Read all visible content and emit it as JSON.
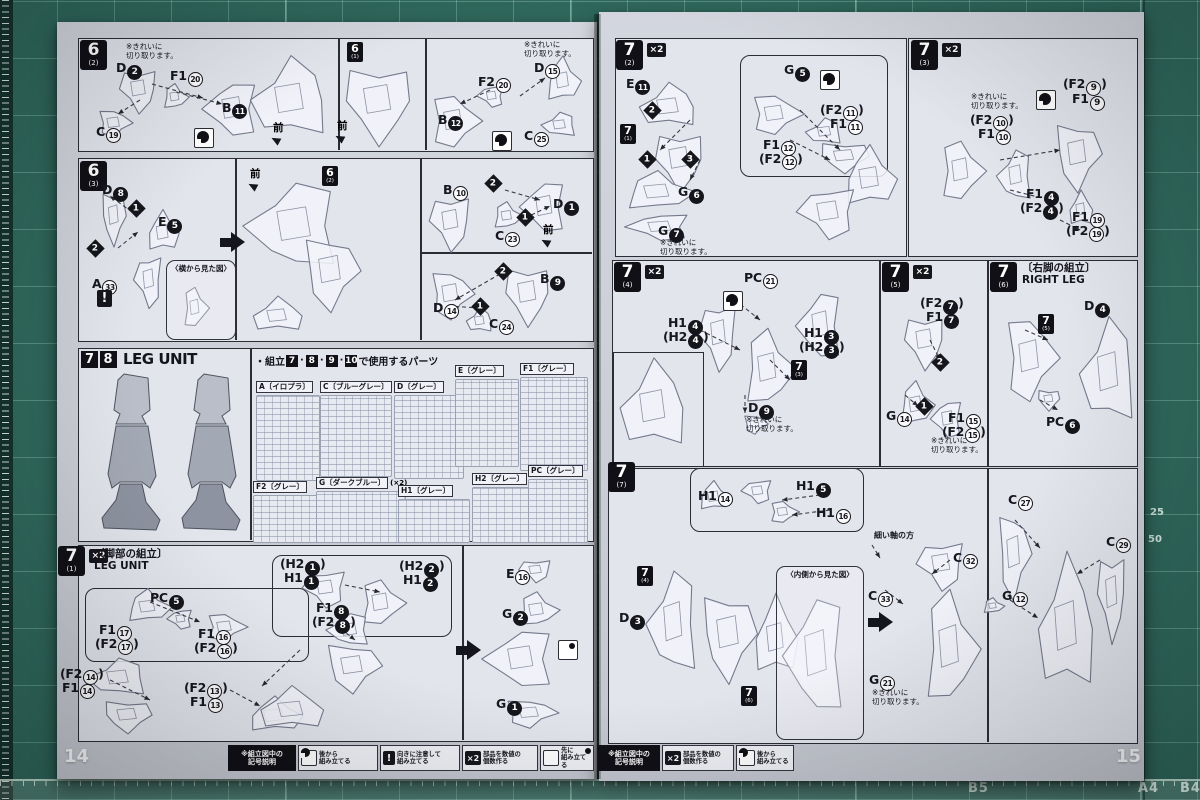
{
  "misc": {
    "x2_label": "×2",
    "warning_glyph": "!"
  },
  "mat": {
    "bottom_labels": [
      {
        "t": "B5",
        "x": 968
      },
      {
        "t": "A4",
        "x": 1138
      },
      {
        "t": "B4",
        "x": 1180
      }
    ],
    "side_labels": [
      {
        "t": "25",
        "x": 1150,
        "y": 507
      },
      {
        "t": "50",
        "x": 1148,
        "y": 534
      }
    ]
  },
  "left_page": {
    "page_number": "14",
    "legend": {
      "x": 228,
      "y": 745,
      "title": "※組立図中の\n記号説明",
      "title_w": 68,
      "items": [
        {
          "icon": "after",
          "t": "後から\n組み立てる",
          "x": 298,
          "w": 80
        },
        {
          "icon": "warning",
          "t": "向きに注意して\n組み立てる",
          "x": 380,
          "w": 80
        },
        {
          "icon": "x2",
          "t": "部品を数値の\n個数作る",
          "x": 462,
          "w": 76
        },
        {
          "icon": "first",
          "t": "先に\n組み立てる",
          "x": 540,
          "w": 54
        }
      ]
    },
    "items": [
      {
        "k": "tag",
        "x": 80,
        "y": 40,
        "num": "6",
        "sub": "(2)"
      },
      {
        "k": "note",
        "x": 126,
        "y": 42,
        "t": "※きれいに\n切り取ります。"
      },
      {
        "k": "part",
        "x": 116,
        "y": 60,
        "t": "D",
        "n": 2,
        "f": 1
      },
      {
        "k": "part",
        "x": 170,
        "y": 68,
        "t": "F1",
        "n": 20
      },
      {
        "k": "part",
        "x": 222,
        "y": 100,
        "t": "B",
        "n": 11,
        "f": 1
      },
      {
        "k": "part",
        "x": 96,
        "y": 124,
        "t": "C",
        "n": 19
      },
      {
        "k": "sym",
        "x": 194,
        "y": 128,
        "icon": "after"
      },
      {
        "k": "dir",
        "x": 273,
        "y": 120,
        "t": "前"
      },
      {
        "k": "ref",
        "x": 347,
        "y": 42,
        "num": "6",
        "sub": "(1)"
      },
      {
        "k": "dir",
        "x": 337,
        "y": 118,
        "t": "前"
      },
      {
        "k": "note",
        "x": 524,
        "y": 40,
        "t": "※きれいに\n切り取ります。"
      },
      {
        "k": "part",
        "x": 534,
        "y": 60,
        "t": "D",
        "n": 15
      },
      {
        "k": "part",
        "x": 478,
        "y": 74,
        "t": "F2",
        "n": 20
      },
      {
        "k": "part",
        "x": 438,
        "y": 112,
        "t": "B",
        "n": 12,
        "f": 1
      },
      {
        "k": "part",
        "x": 524,
        "y": 128,
        "t": "C",
        "n": 25
      },
      {
        "k": "sym",
        "x": 492,
        "y": 131,
        "icon": "after"
      },
      {
        "k": "tag",
        "x": 80,
        "y": 161,
        "num": "6",
        "sub": "(3)"
      },
      {
        "k": "part",
        "x": 102,
        "y": 182,
        "t": "D",
        "n": 8,
        "f": 1
      },
      {
        "k": "dia",
        "x": 130,
        "y": 202,
        "n": 1
      },
      {
        "k": "part",
        "x": 158,
        "y": 214,
        "t": "E",
        "n": 5,
        "f": 1
      },
      {
        "k": "dia",
        "x": 89,
        "y": 242,
        "n": 2
      },
      {
        "k": "part",
        "x": 92,
        "y": 276,
        "t": "A",
        "n": 33
      },
      {
        "k": "sym",
        "x": 97,
        "y": 290,
        "icon": "warning"
      },
      {
        "k": "callout",
        "x": 166,
        "y": 260,
        "w": 68,
        "h": 78,
        "t": "〈横から見た図〉"
      },
      {
        "k": "dir",
        "x": 250,
        "y": 166,
        "t": "前"
      },
      {
        "k": "bigarrow",
        "x": 220,
        "y": 232
      },
      {
        "k": "ref",
        "x": 322,
        "y": 166,
        "num": "6",
        "sub": "(2)"
      },
      {
        "k": "part",
        "x": 443,
        "y": 182,
        "t": "B",
        "n": 10
      },
      {
        "k": "dia",
        "x": 487,
        "y": 177,
        "n": 2
      },
      {
        "k": "part",
        "x": 553,
        "y": 196,
        "t": "D",
        "n": 1,
        "f": 1
      },
      {
        "k": "dia",
        "x": 519,
        "y": 211,
        "n": 1
      },
      {
        "k": "part",
        "x": 495,
        "y": 228,
        "t": "C",
        "n": 23
      },
      {
        "k": "dir",
        "x": 543,
        "y": 222,
        "t": "前"
      },
      {
        "k": "dia",
        "x": 497,
        "y": 265,
        "n": 2
      },
      {
        "k": "part",
        "x": 540,
        "y": 271,
        "t": "B",
        "n": 9,
        "f": 1
      },
      {
        "k": "part",
        "x": 433,
        "y": 300,
        "t": "D",
        "n": 14
      },
      {
        "k": "dia",
        "x": 474,
        "y": 300,
        "n": 1
      },
      {
        "k": "part",
        "x": 489,
        "y": 316,
        "t": "C",
        "n": 24
      },
      {
        "k": "boxhead",
        "x": 81,
        "y": 350,
        "nums": [
          "7",
          "8"
        ],
        "t": "LEG UNIT"
      },
      {
        "k": "plisthead",
        "x": 255,
        "y": 353,
        "pre": "・組立",
        "nums": [
          "7",
          "8",
          "9",
          "10"
        ],
        "post": "で使用するパーツ"
      },
      {
        "k": "runner",
        "x": 256,
        "y": 374,
        "t": "A〔イロプラ〕",
        "tw": 62,
        "th": 84
      },
      {
        "k": "runner",
        "x": 320,
        "y": 374,
        "t": "C〔ブルーグレー〕",
        "tw": 70,
        "th": 80
      },
      {
        "k": "runner",
        "x": 394,
        "y": 374,
        "t": "D〔グレー〕",
        "tw": 68,
        "th": 82
      },
      {
        "k": "runner",
        "x": 455,
        "y": 358,
        "t": "E〔グレー〕",
        "tw": 62,
        "th": 86
      },
      {
        "k": "runner",
        "x": 520,
        "y": 356,
        "t": "F1〔グレー〕",
        "tw": 66,
        "th": 92
      },
      {
        "k": "runner",
        "x": 253,
        "y": 474,
        "t": "F2〔グレー〕",
        "tw": 64,
        "th": 46
      },
      {
        "k": "runner",
        "x": 316,
        "y": 470,
        "t": "G〔ダークブルー〕",
        "extra": "(×2)",
        "tw": 88,
        "th": 50
      },
      {
        "k": "runner",
        "x": 398,
        "y": 478,
        "t": "H1〔グレー〕",
        "tw": 70,
        "th": 42
      },
      {
        "k": "runner",
        "x": 472,
        "y": 466,
        "t": "H2〔グレー〕",
        "tw": 56,
        "th": 54
      },
      {
        "k": "runner",
        "x": 528,
        "y": 458,
        "t": "PC〔グレー〕",
        "tw": 58,
        "th": 62
      },
      {
        "k": "tag",
        "x": 58,
        "y": 546,
        "num": "7",
        "sub": "(1)",
        "x2": 1
      },
      {
        "k": "head2",
        "x": 94,
        "y": 548,
        "t1": "〔脚部の組立〕",
        "t2": "LEG UNIT"
      },
      {
        "k": "part",
        "x": 150,
        "y": 590,
        "t": "PC",
        "n": 5,
        "f": 1
      },
      {
        "k": "part",
        "x": 99,
        "y": 622,
        "t": "F1",
        "n": 17
      },
      {
        "k": "part",
        "x": 95,
        "y": 636,
        "t": "F2",
        "n": 17,
        "p": 1
      },
      {
        "k": "part",
        "x": 198,
        "y": 626,
        "t": "F1",
        "n": 16
      },
      {
        "k": "part",
        "x": 194,
        "y": 640,
        "t": "F2",
        "n": 16,
        "p": 1
      },
      {
        "k": "part",
        "x": 60,
        "y": 666,
        "t": "F2",
        "n": 14,
        "p": 1
      },
      {
        "k": "part",
        "x": 62,
        "y": 680,
        "t": "F1",
        "n": 14
      },
      {
        "k": "part",
        "x": 184,
        "y": 680,
        "t": "F2",
        "n": 13,
        "p": 1
      },
      {
        "k": "part",
        "x": 190,
        "y": 694,
        "t": "F1",
        "n": 13
      },
      {
        "k": "part",
        "x": 280,
        "y": 556,
        "t": "H2",
        "n": 1,
        "f": 1,
        "p": 1
      },
      {
        "k": "part",
        "x": 284,
        "y": 570,
        "t": "H1",
        "n": 1,
        "f": 1
      },
      {
        "k": "part",
        "x": 399,
        "y": 558,
        "t": "H2",
        "n": 2,
        "f": 1,
        "p": 1
      },
      {
        "k": "part",
        "x": 403,
        "y": 572,
        "t": "H1",
        "n": 2,
        "f": 1
      },
      {
        "k": "part",
        "x": 316,
        "y": 600,
        "t": "F1",
        "n": 8,
        "f": 1
      },
      {
        "k": "part",
        "x": 312,
        "y": 614,
        "t": "F2",
        "n": 8,
        "f": 1,
        "p": 1
      },
      {
        "k": "bigarrow",
        "x": 456,
        "y": 640
      },
      {
        "k": "part",
        "x": 506,
        "y": 566,
        "t": "E",
        "n": 16
      },
      {
        "k": "part",
        "x": 502,
        "y": 606,
        "t": "G",
        "n": 2,
        "f": 1
      },
      {
        "k": "sym",
        "x": 558,
        "y": 640,
        "icon": "first"
      },
      {
        "k": "part",
        "x": 496,
        "y": 696,
        "t": "G",
        "n": 1,
        "f": 1
      }
    ]
  },
  "right_page": {
    "page_number": "15",
    "legend": {
      "x": 598,
      "y": 745,
      "title": "※組立図中の\n記号説明",
      "title_w": 62,
      "items": [
        {
          "icon": "x2",
          "t": "部品を数値の\n個数作る",
          "x": 662,
          "w": 72
        },
        {
          "icon": "after",
          "t": "後から\n組み立てる",
          "x": 736,
          "w": 58
        }
      ]
    },
    "items": [
      {
        "k": "tag",
        "x": 616,
        "y": 40,
        "num": "7",
        "sub": "(2)",
        "x2": 1
      },
      {
        "k": "part",
        "x": 626,
        "y": 76,
        "t": "E",
        "n": 11,
        "f": 1
      },
      {
        "k": "dia",
        "x": 646,
        "y": 104,
        "n": 2
      },
      {
        "k": "ref",
        "x": 620,
        "y": 124,
        "num": "7",
        "sub": "(1)"
      },
      {
        "k": "dia",
        "x": 641,
        "y": 153,
        "n": 1
      },
      {
        "k": "dia",
        "x": 684,
        "y": 153,
        "n": 3
      },
      {
        "k": "part",
        "x": 678,
        "y": 184,
        "t": "G",
        "n": 6,
        "f": 1
      },
      {
        "k": "part",
        "x": 658,
        "y": 223,
        "t": "G",
        "n": 7,
        "f": 1
      },
      {
        "k": "note",
        "x": 660,
        "y": 238,
        "t": "※きれいに\n切り取ります。"
      },
      {
        "k": "part",
        "x": 784,
        "y": 62,
        "t": "G",
        "n": 5,
        "f": 1
      },
      {
        "k": "sym",
        "x": 820,
        "y": 70,
        "icon": "after"
      },
      {
        "k": "part",
        "x": 820,
        "y": 102,
        "t": "F2",
        "n": 11,
        "p": 1
      },
      {
        "k": "part",
        "x": 830,
        "y": 116,
        "t": "F1",
        "n": 11
      },
      {
        "k": "part",
        "x": 763,
        "y": 137,
        "t": "F1",
        "n": 12
      },
      {
        "k": "part",
        "x": 759,
        "y": 151,
        "t": "F2",
        "n": 12,
        "p": 1
      },
      {
        "k": "tag",
        "x": 911,
        "y": 40,
        "num": "7",
        "sub": "(3)",
        "x2": 1
      },
      {
        "k": "note",
        "x": 971,
        "y": 92,
        "t": "※きれいに\n切り取ります。"
      },
      {
        "k": "sym",
        "x": 1036,
        "y": 90,
        "icon": "after"
      },
      {
        "k": "part",
        "x": 1063,
        "y": 76,
        "t": "F2",
        "n": 9,
        "p": 1
      },
      {
        "k": "part",
        "x": 1072,
        "y": 91,
        "t": "F1",
        "n": 9
      },
      {
        "k": "part",
        "x": 970,
        "y": 112,
        "t": "F2",
        "n": 10,
        "p": 1
      },
      {
        "k": "part",
        "x": 978,
        "y": 126,
        "t": "F1",
        "n": 10
      },
      {
        "k": "part",
        "x": 1026,
        "y": 186,
        "t": "F1",
        "n": 4,
        "f": 1
      },
      {
        "k": "part",
        "x": 1020,
        "y": 200,
        "t": "F2",
        "n": 4,
        "f": 1,
        "p": 1
      },
      {
        "k": "part",
        "x": 1072,
        "y": 209,
        "t": "F1",
        "n": 19
      },
      {
        "k": "part",
        "x": 1066,
        "y": 223,
        "t": "F2",
        "n": 19,
        "p": 1
      },
      {
        "k": "tag",
        "x": 614,
        "y": 262,
        "num": "7",
        "sub": "(4)",
        "x2": 1
      },
      {
        "k": "part",
        "x": 744,
        "y": 270,
        "t": "PC",
        "n": 21
      },
      {
        "k": "sym",
        "x": 723,
        "y": 291,
        "icon": "after"
      },
      {
        "k": "part",
        "x": 668,
        "y": 315,
        "t": "H1",
        "n": 4,
        "f": 1
      },
      {
        "k": "part",
        "x": 663,
        "y": 329,
        "t": "H2",
        "n": 4,
        "f": 1,
        "p": 1
      },
      {
        "k": "part",
        "x": 804,
        "y": 325,
        "t": "H1",
        "n": 3,
        "f": 1
      },
      {
        "k": "part",
        "x": 799,
        "y": 339,
        "t": "H2",
        "n": 3,
        "f": 1,
        "p": 1
      },
      {
        "k": "ref",
        "x": 791,
        "y": 360,
        "num": "7",
        "sub": "(3)"
      },
      {
        "k": "part",
        "x": 748,
        "y": 400,
        "t": "D",
        "n": 9,
        "f": 1
      },
      {
        "k": "note",
        "x": 746,
        "y": 415,
        "t": "※きれいに\n切り取ります。"
      },
      {
        "k": "tag",
        "x": 882,
        "y": 262,
        "num": "7",
        "sub": "(5)",
        "x2": 1
      },
      {
        "k": "part",
        "x": 920,
        "y": 295,
        "t": "F2",
        "n": 7,
        "f": 1,
        "p": 1
      },
      {
        "k": "part",
        "x": 926,
        "y": 309,
        "t": "F1",
        "n": 7,
        "f": 1
      },
      {
        "k": "dia",
        "x": 934,
        "y": 356,
        "n": 2
      },
      {
        "k": "dia",
        "x": 918,
        "y": 400,
        "n": 1
      },
      {
        "k": "part",
        "x": 886,
        "y": 408,
        "t": "G",
        "n": 14
      },
      {
        "k": "part",
        "x": 948,
        "y": 410,
        "t": "F1",
        "n": 15
      },
      {
        "k": "part",
        "x": 942,
        "y": 424,
        "t": "F2",
        "n": 15,
        "p": 1
      },
      {
        "k": "note",
        "x": 931,
        "y": 436,
        "t": "※きれいに\n切り取ります。"
      },
      {
        "k": "tag",
        "x": 990,
        "y": 262,
        "num": "7",
        "sub": "(6)"
      },
      {
        "k": "head2",
        "x": 1022,
        "y": 262,
        "t1": "〔右脚の組立〕",
        "t2": "RIGHT LEG"
      },
      {
        "k": "part",
        "x": 1084,
        "y": 298,
        "t": "D",
        "n": 4,
        "f": 1
      },
      {
        "k": "ref",
        "x": 1038,
        "y": 314,
        "num": "7",
        "sub": "(5)"
      },
      {
        "k": "part",
        "x": 1046,
        "y": 414,
        "t": "PC",
        "n": 6,
        "f": 1
      },
      {
        "k": "tag",
        "x": 608,
        "y": 462,
        "num": "7",
        "sub": "(7)"
      },
      {
        "k": "part",
        "x": 698,
        "y": 488,
        "t": "H1",
        "n": 14
      },
      {
        "k": "part",
        "x": 796,
        "y": 478,
        "t": "H1",
        "n": 5,
        "f": 1
      },
      {
        "k": "part",
        "x": 816,
        "y": 505,
        "t": "H1",
        "n": 16
      },
      {
        "k": "annot",
        "x": 874,
        "y": 530,
        "t": "細い軸の方"
      },
      {
        "k": "ref",
        "x": 637,
        "y": 566,
        "num": "7",
        "sub": "(4)"
      },
      {
        "k": "part",
        "x": 619,
        "y": 610,
        "t": "D",
        "n": 3,
        "f": 1
      },
      {
        "k": "callout",
        "x": 776,
        "y": 566,
        "w": 86,
        "h": 172,
        "t": "〈内側から見た図〉"
      },
      {
        "k": "part",
        "x": 953,
        "y": 550,
        "t": "C",
        "n": 32
      },
      {
        "k": "part",
        "x": 868,
        "y": 588,
        "t": "C",
        "n": 33
      },
      {
        "k": "ref",
        "x": 741,
        "y": 686,
        "num": "7",
        "sub": "(6)"
      },
      {
        "k": "part",
        "x": 869,
        "y": 672,
        "t": "G",
        "n": 21
      },
      {
        "k": "note",
        "x": 872,
        "y": 688,
        "t": "※きれいに\n切り取ります。"
      },
      {
        "k": "bigarrow",
        "x": 868,
        "y": 612
      },
      {
        "k": "part",
        "x": 1008,
        "y": 492,
        "t": "C",
        "n": 27
      },
      {
        "k": "part",
        "x": 1002,
        "y": 588,
        "t": "G",
        "n": 12
      },
      {
        "k": "part",
        "x": 1106,
        "y": 534,
        "t": "C",
        "n": 29
      }
    ]
  }
}
